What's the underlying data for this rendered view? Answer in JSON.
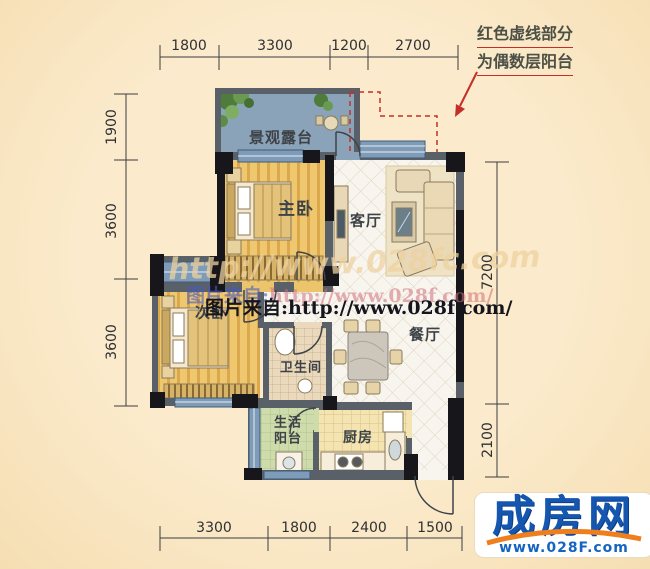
{
  "plan": {
    "rooms": {
      "terrace": "景观露台",
      "master_bedroom": "主卧",
      "living_room": "客厅",
      "second_bedroom": "次卧",
      "bathroom": "卫生间",
      "dining_room": "餐厅",
      "utility_balcony_line1": "生活",
      "utility_balcony_line2": "阳台",
      "kitchen": "厨房"
    },
    "dimensions": {
      "top": [
        "1800",
        "3300",
        "1200",
        "2700"
      ],
      "left": [
        "1900",
        "3600",
        "3600"
      ],
      "right": [
        "7200",
        "2100"
      ],
      "bottom": [
        "3300",
        "1800",
        "2400",
        "1500"
      ]
    }
  },
  "annotation": {
    "line1": "红色虚线部分",
    "line2": "为偶数层阳台"
  },
  "watermarks": {
    "ghost_url": "http://www.028fc.com",
    "overlay_colored_prefix": "图片来自:",
    "overlay_colored_url": "http://www.028f.com/",
    "overlay_black": "图片来自:http://www.028f.com/"
  },
  "logo": {
    "name": "成房网",
    "url": "www.028F.com"
  },
  "colors": {
    "background": "#fbeacb",
    "terrace_floor": "#8aa3b8",
    "wood_floor": "#ecc46b",
    "tile_floor": "#f8f5ee",
    "wall": "#596067",
    "column": "#17171b",
    "window": "#7e9cb7",
    "red_accent": "#c43028",
    "logo_blue": "#1557b0",
    "logo_orange": "#ee7f1c"
  }
}
